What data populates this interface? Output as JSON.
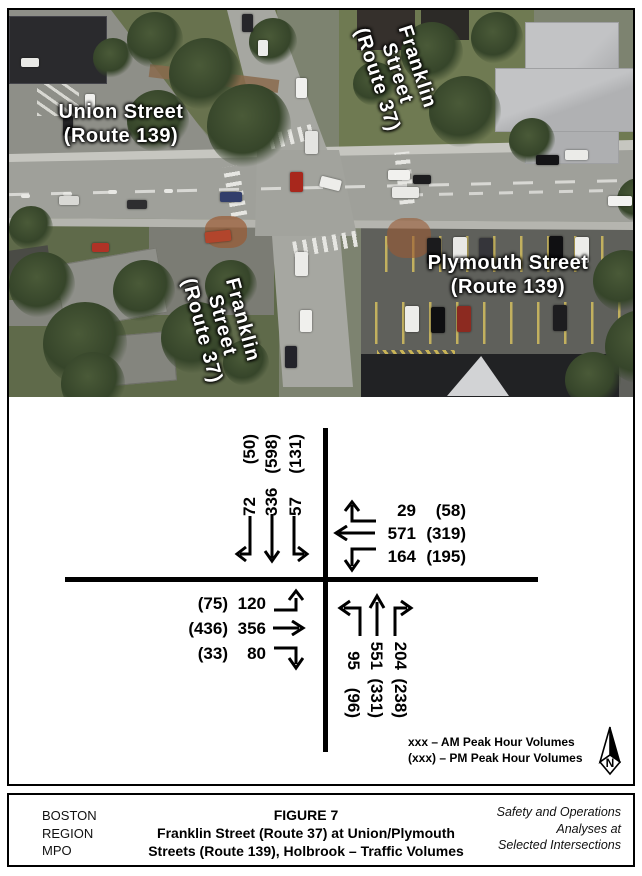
{
  "photo": {
    "street_labels": {
      "union": {
        "lines": [
          "Union Street",
          "(Route 139)"
        ]
      },
      "franklin_north": {
        "lines": [
          "Franklin",
          "Street",
          "(Route 37)"
        ]
      },
      "plymouth": {
        "lines": [
          "Plymouth Street",
          "(Route 139)"
        ]
      },
      "franklin_south": {
        "lines": [
          "Franklin",
          "Street",
          "(Route 37)"
        ]
      }
    }
  },
  "diagram": {
    "southbound": {
      "movements": [
        {
          "turn": "right",
          "am": "72",
          "pm": "(50)"
        },
        {
          "turn": "through",
          "am": "336",
          "pm": "(598)"
        },
        {
          "turn": "left",
          "am": "57",
          "pm": "(131)"
        }
      ]
    },
    "westbound": {
      "movements": [
        {
          "turn": "left",
          "am": "29",
          "pm": "(58)"
        },
        {
          "turn": "through",
          "am": "571",
          "pm": "(319)"
        },
        {
          "turn": "right",
          "am": "164",
          "pm": "(195)"
        }
      ]
    },
    "eastbound": {
      "movements": [
        {
          "turn": "left",
          "pm": "(75)",
          "am": "120"
        },
        {
          "turn": "through",
          "pm": "(436)",
          "am": "356"
        },
        {
          "turn": "right",
          "pm": "(33)",
          "am": "80"
        }
      ]
    },
    "northbound": {
      "movements": [
        {
          "turn": "left",
          "am": "95",
          "pm": "(96)"
        },
        {
          "turn": "through",
          "am": "551",
          "pm": "(331)"
        },
        {
          "turn": "right",
          "am": "204",
          "pm": "(238)"
        }
      ]
    },
    "legend": {
      "am_line": "xxx – AM Peak Hour Volumes",
      "pm_line": "(xxx) – PM Peak Hour Volumes"
    },
    "compass_label": "N"
  },
  "title_block": {
    "org_lines": [
      "BOSTON",
      "REGION",
      "MPO"
    ],
    "figure_label": "FIGURE 7",
    "title_lines": [
      "Franklin Street (Route 37) at Union/Plymouth",
      "Streets (Route 139), Holbrook – Traffic Volumes"
    ],
    "project_lines": [
      "Safety and Operations",
      "Analyses at",
      "Selected Intersections"
    ]
  },
  "colors": {
    "diagram_line": "#000000",
    "photo_label_text": "#ffffff",
    "volume_text": "#000000"
  }
}
